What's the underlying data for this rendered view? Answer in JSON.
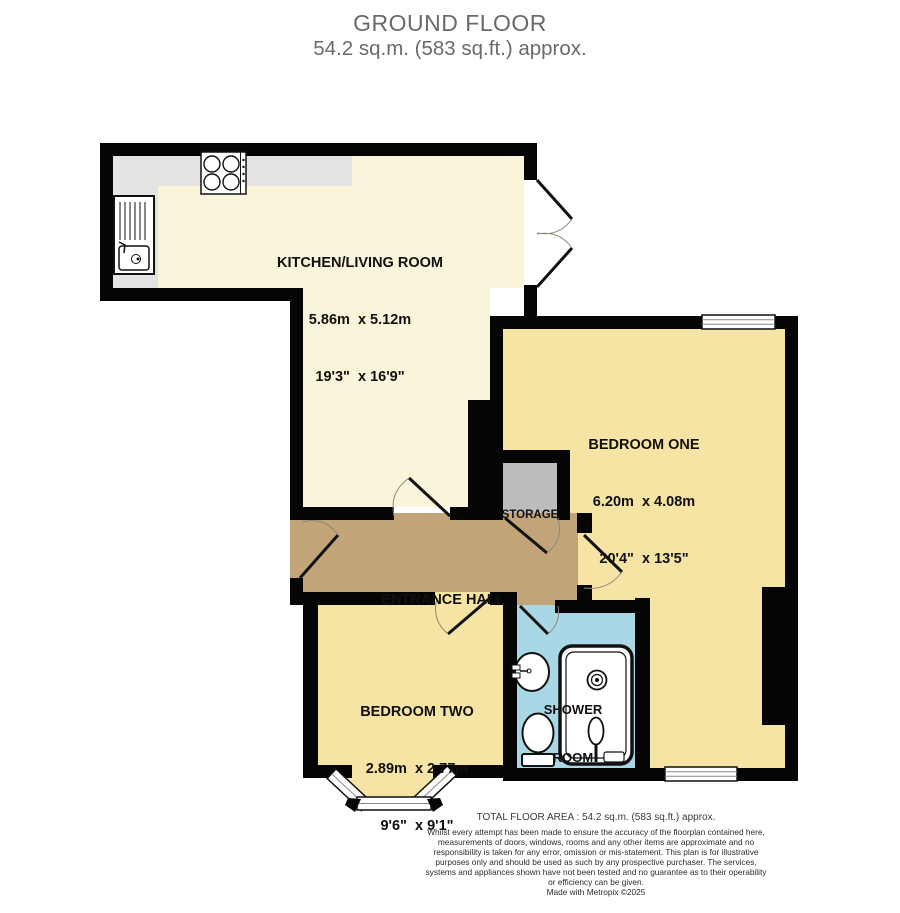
{
  "title": {
    "line1": "GROUND FLOOR",
    "line2": "54.2 sq.m. (583 sq.ft.) approx."
  },
  "rooms": {
    "kitchen_living": {
      "name": "KITCHEN/LIVING ROOM",
      "metric": "5.86m  x 5.12m",
      "imperial": "19'3\"  x 16'9\""
    },
    "bedroom_one": {
      "name": "BEDROOM ONE",
      "metric": "6.20m  x 4.08m",
      "imperial": "20'4\"  x 13'5\""
    },
    "bedroom_two": {
      "name": "BEDROOM TWO",
      "metric": "2.89m  x 2.77m",
      "imperial": "9'6\"  x 9'1\""
    },
    "entrance_hall": {
      "name": "ENTRANCE HALL"
    },
    "storage": {
      "name": "STORAGE"
    },
    "shower_room": {
      "name_line1": "SHOWER",
      "name_line2": "ROOM"
    }
  },
  "fixtures": [
    "hob",
    "sink-unit",
    "shower-enclosure",
    "shower-head",
    "toilet",
    "basin",
    "bay-window",
    "window",
    "door-swing",
    "french-doors"
  ],
  "colors": {
    "wall": "#050505",
    "kitchen_living_floor": "#FAF4DA",
    "bedroom_floor": "#F6E4A4",
    "hall_floor": "#C3A479",
    "shower_floor": "#A9D7E5",
    "storage_floor": "#BCBCBC",
    "counter": "#E3E3E3",
    "title_text": "#6a6a6a",
    "label_text": "#101010"
  },
  "footer": {
    "total_area": "TOTAL FLOOR AREA : 54.2 sq.m. (583 sq.ft.) approx.",
    "disclaimer": "Whilst every attempt has been made to ensure the accuracy of the floorplan contained here, measurements of doors, windows, rooms and any other items are approximate and no responsibility is taken for any error, omission or mis-statement. This plan is for illustrative purposes only and should be used as such by any prospective purchaser. The services, systems and appliances shown have not been tested and no guarantee as to their operability or efficiency can be given.",
    "credit": "Made with Metropix ©2025"
  }
}
